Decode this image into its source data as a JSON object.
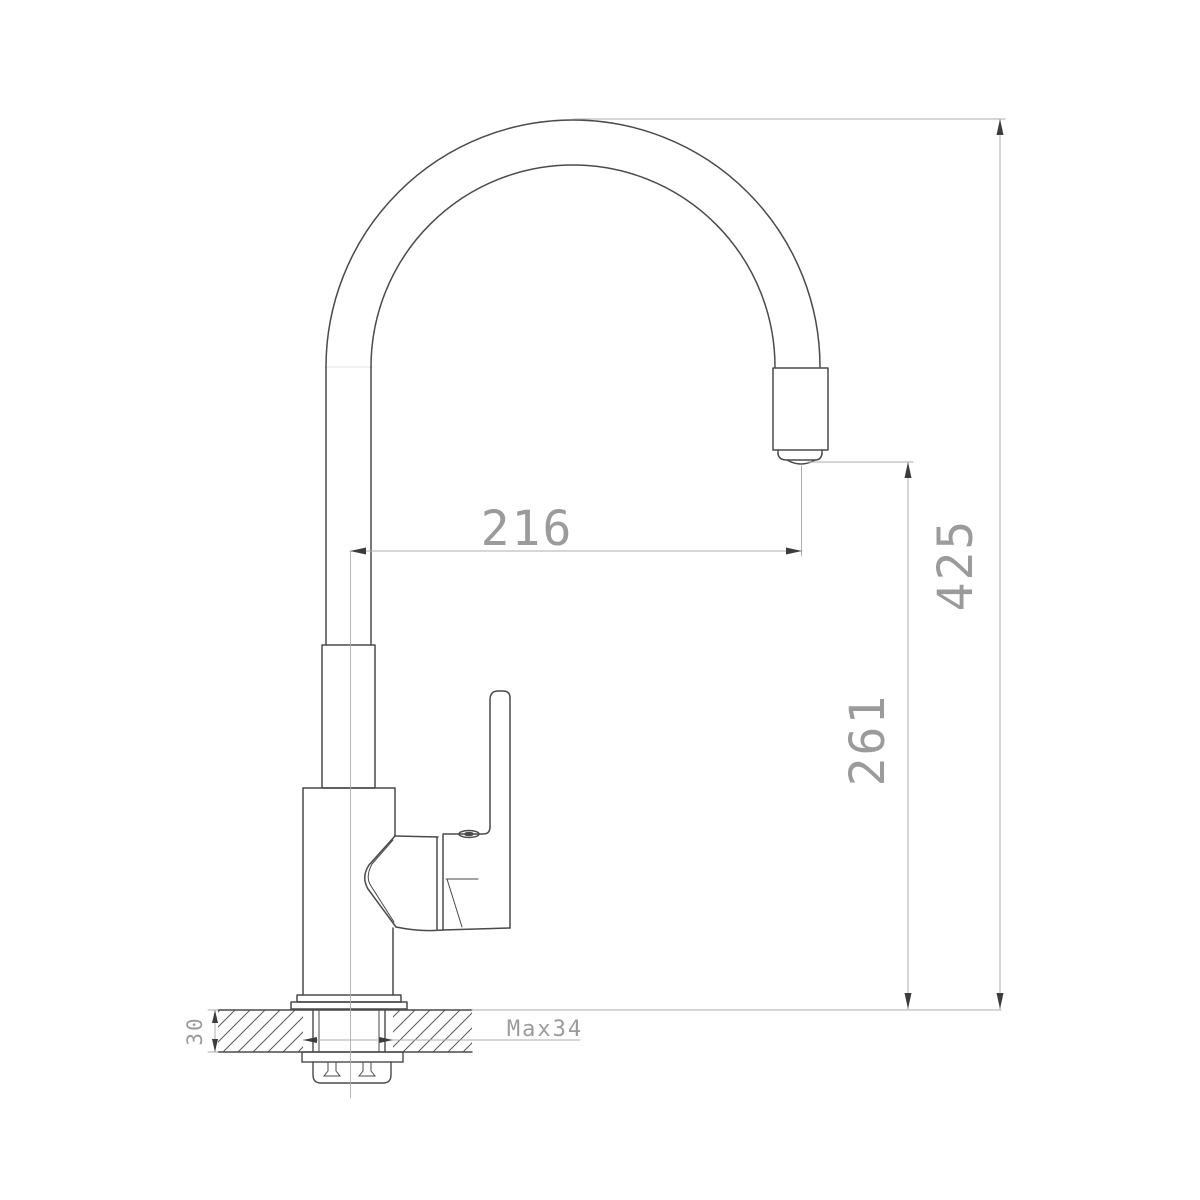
{
  "drawing": {
    "subject": "single-lever kitchen faucet side elevation with countertop mounting cross-section",
    "background_color": "#ffffff",
    "outline_color": "#4a4a4a",
    "accent_color": "#5a5a5a",
    "dim_line_color": "#adadad",
    "dim_text_color": "#9b9b9b",
    "arrow_color": "#3c3c3c"
  },
  "dimensions": {
    "spout_reach": "216",
    "overall_height": "425",
    "spout_outlet_height": "261",
    "counter_thickness": "30",
    "max_mounting": "Max34"
  }
}
